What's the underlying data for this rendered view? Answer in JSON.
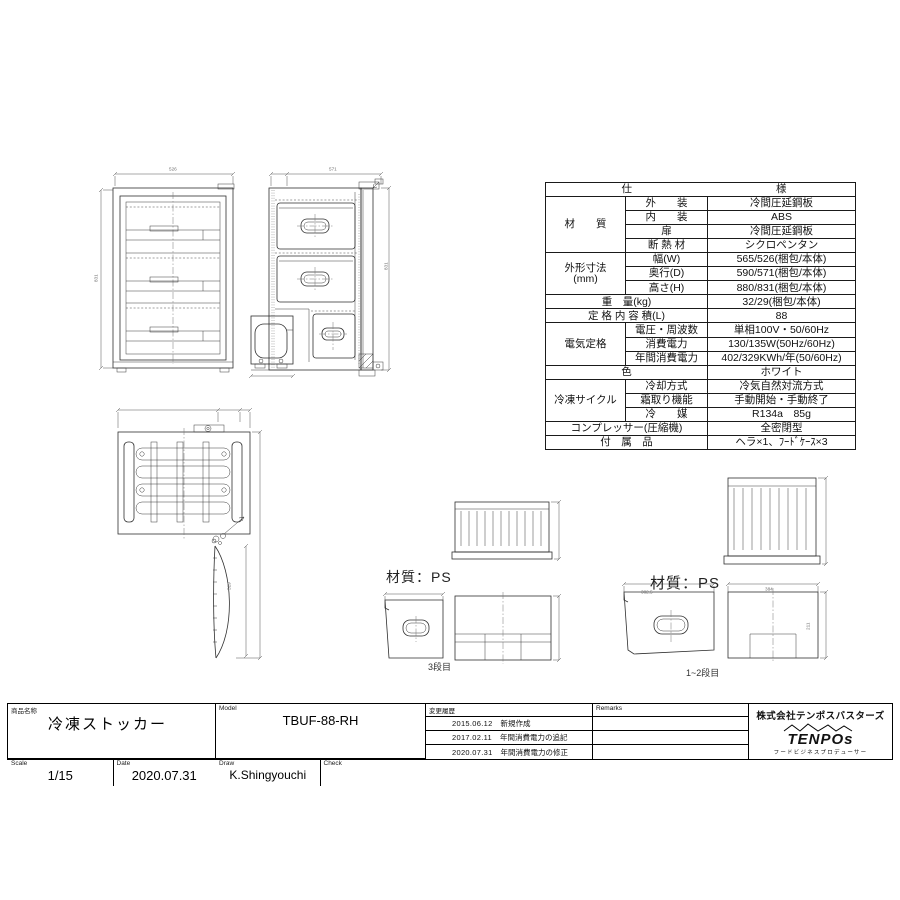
{
  "spec_table": {
    "header": {
      "left": "仕",
      "right": "様"
    },
    "rows": [
      {
        "group": "材　　質",
        "label": "外　　装",
        "value": "冷間圧延鋼板"
      },
      {
        "label": "内　　装",
        "value": "ABS"
      },
      {
        "label": "扉",
        "value": "冷間圧延鋼板"
      },
      {
        "label": "断 熱 材",
        "value": "シクロペンタン"
      },
      {
        "group": "外形寸法\n(mm)",
        "label": "幅(W)",
        "value": "565/526(梱包/本体)"
      },
      {
        "label": "奥行(D)",
        "value": "590/571(梱包/本体)"
      },
      {
        "label": "高さ(H)",
        "value": "880/831(梱包/本体)"
      },
      {
        "label": "重　量(kg)",
        "value": "32/29(梱包/本体)"
      },
      {
        "label": "定 格 内 容 積(L)",
        "value": "88"
      },
      {
        "group": "電気定格",
        "label": "電圧・周波数",
        "value": "単相100V・50/60Hz"
      },
      {
        "label": "消費電力",
        "value": "130/135W(50Hz/60Hz)"
      },
      {
        "label": "年間消費電力",
        "value": "402/329KWh/年(50/60Hz)"
      },
      {
        "label": "色",
        "value": "ホワイト"
      },
      {
        "group": "冷凍サイクル",
        "label": "冷却方式",
        "value": "冷気自然対流方式"
      },
      {
        "label": "霜取り機能",
        "value": "手動開始・手動終了"
      },
      {
        "label": "冷　　媒",
        "value": "R134a　85g"
      },
      {
        "label": "コンプレッサー(圧縮機)",
        "value": "全密閉型"
      },
      {
        "label": "付　属　品",
        "value": "ヘラ×1、ﾌｰﾄﾞｹｰｽ×3"
      }
    ]
  },
  "drawings": {
    "front_width": "526",
    "front_height": "831",
    "side_depth": "571",
    "side_height": "831",
    "door_dim": "529",
    "case3_material": "材質：PS",
    "case3_caption": "3段目",
    "case12_material": "材質：PS",
    "case12_caption": "1~2段目",
    "case12_side_width": "382.5",
    "case12_front_width": "384",
    "case12_height": "211"
  },
  "title_block": {
    "product_label": "商品名称",
    "product_name": "冷凍ストッカー",
    "model_label": "Model",
    "model": "TBUF-88-RH",
    "scale_label": "Scale",
    "scale": "1/15",
    "date_label": "Date",
    "date": "2020.07.31",
    "draw_label": "Draw",
    "draw": "K.Shingyouchi",
    "check_label": "Check",
    "history_label": "変更履歴",
    "history": [
      {
        "date": "2015.06.12",
        "note": "新規作成"
      },
      {
        "date": "2017.02.11",
        "note": "年間消費電力の追記"
      },
      {
        "date": "2020.07.31",
        "note": "年間消費電力の修正"
      }
    ],
    "remarks_label": "Remarks",
    "company": "株式会社テンポスバスターズ",
    "logo_text": "TENPOs",
    "logo_tagline": "フードビジネスプロデューサー"
  }
}
